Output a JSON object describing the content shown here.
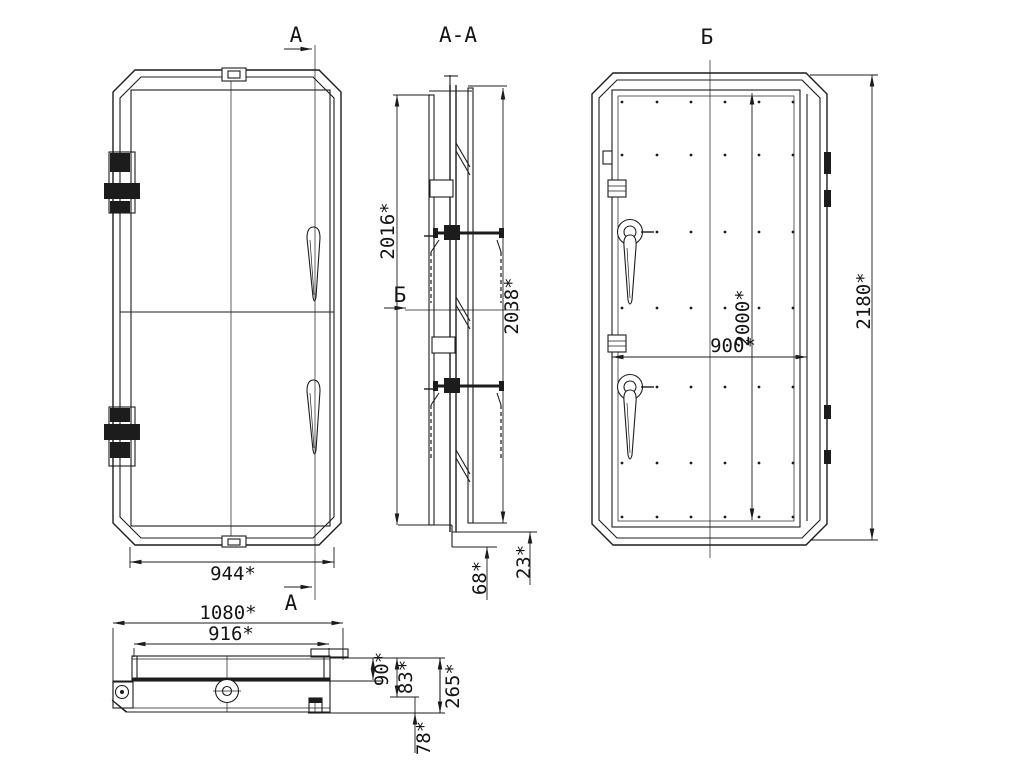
{
  "drawing": {
    "type": "technical-drawing-door",
    "colors": {
      "line": "#1c1c1c",
      "background": "#ffffff"
    },
    "cut_marks": {
      "a_top": "А",
      "a_bottom": "А",
      "b_arrow": "Б"
    },
    "front": {
      "width": "944*"
    },
    "plan": {
      "overall_width": "1080*",
      "leaf_width": "916*",
      "depth_90": "90*",
      "depth_83": "83*",
      "depth_265": "265*",
      "depth_78": "78*"
    },
    "section": {
      "title": "А-А",
      "leaf_height": "2016*",
      "frame_height": "2038*",
      "sill_68": "68*",
      "sill_23": "23*"
    },
    "back": {
      "title": "Б",
      "opening_width": "900*",
      "opening_height": "2000*",
      "overall_height": "2180*"
    }
  }
}
